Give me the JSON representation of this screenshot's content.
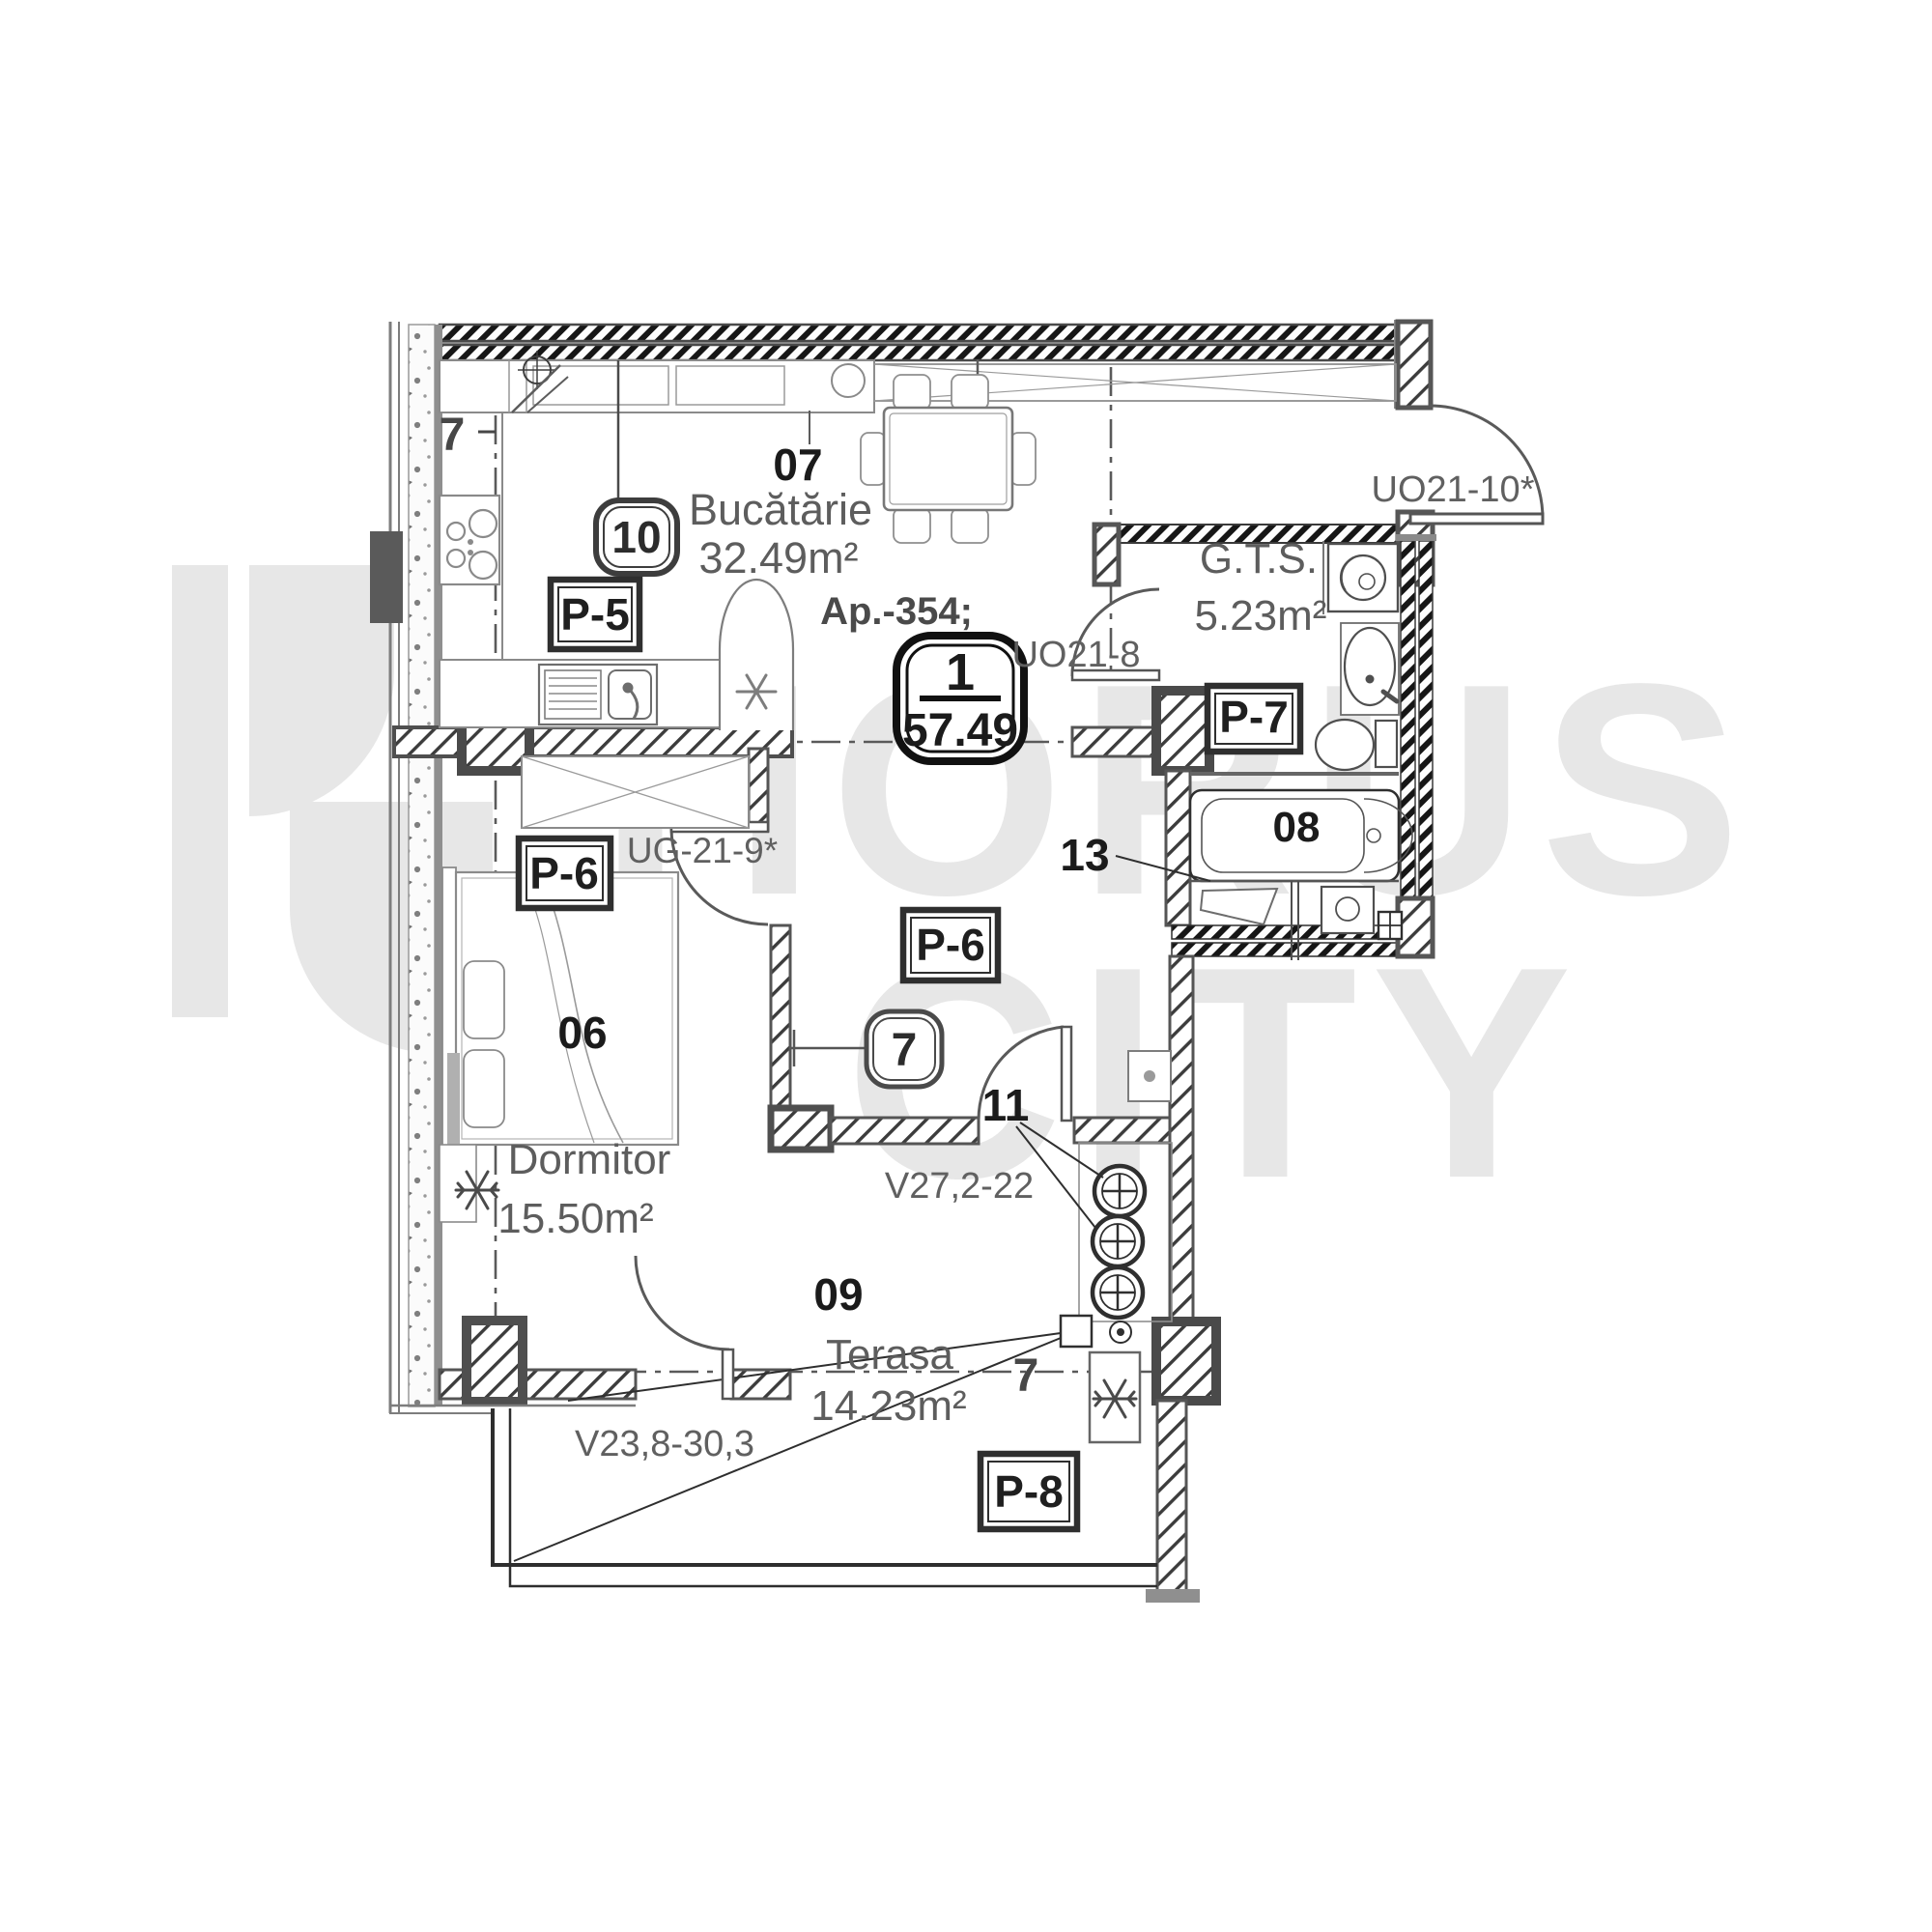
{
  "watermark": {
    "line1": "HORUS",
    "line2": "CITY"
  },
  "plan": {
    "apartment_label": "Ap.-354;",
    "badge": {
      "number": "1",
      "area": "57.49"
    },
    "axis": {
      "top": "7",
      "bottom": "7"
    },
    "rooms": [
      {
        "number": "07",
        "name": "Bucătărie",
        "area": "32.49m²"
      },
      {
        "number": "",
        "name": "G.T.S.",
        "area": "5.23m²"
      },
      {
        "number": "06",
        "name": "Dormitor",
        "area": "15.50m²"
      },
      {
        "number": "08",
        "name": "",
        "area": ""
      },
      {
        "number": "09",
        "name": "Terasa",
        "area": "14.23m²"
      }
    ],
    "doors": {
      "entrance": "UO21-10*",
      "gts": "UO21-8",
      "bedroom": "UG-21-9*"
    },
    "windows": {
      "hall_terrace": "V27,2-22",
      "bedroom_terrace": "V23,8-30,3"
    },
    "panels": {
      "p5": "P-5",
      "p6_bedroom": "P-6",
      "p6_hall": "P-6",
      "p7": "P-7",
      "p8": "P-8"
    },
    "markers": {
      "badge_10": "10",
      "badge_7": "7",
      "riser_label": "11",
      "wall_label": "13"
    }
  }
}
